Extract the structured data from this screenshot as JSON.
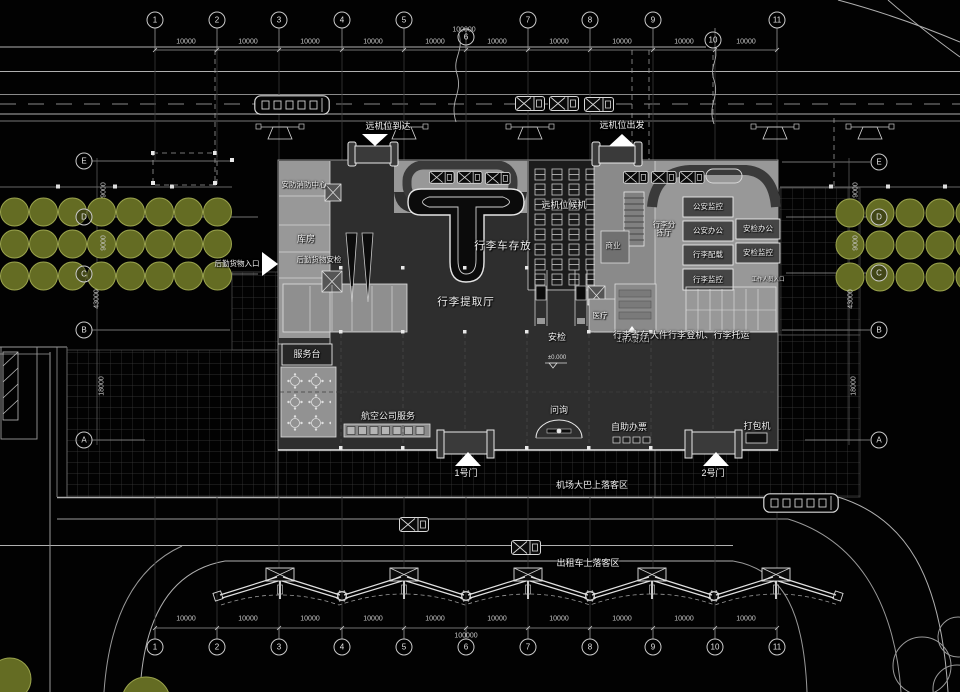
{
  "grid": {
    "top": [
      "1",
      "2",
      "3",
      "4",
      "5",
      "6",
      "7",
      "8",
      "9",
      "10",
      "11"
    ],
    "bottom": [
      "1",
      "2",
      "3",
      "4",
      "5",
      "6",
      "7",
      "8",
      "9",
      "10",
      "11"
    ],
    "left": [
      "E",
      "D",
      "C",
      "B",
      "A"
    ],
    "right": [
      "E",
      "D",
      "C",
      "B",
      "A"
    ]
  },
  "dims": {
    "bay": "10000",
    "total": "100000",
    "v9000": "9000",
    "v43000": "43000",
    "v18000": "18000",
    "level": "±0.000"
  },
  "site": {
    "remote_arrival": "远机位到达",
    "remote_departure": "远机位出发",
    "cargo_entrance": "后勤货物入口",
    "bus_zone": "机场大巴上落客区",
    "taxi_zone": "出租车上落客区",
    "gate1": "1号门",
    "gate2": "2号门",
    "staff_entrance": "工作人员入口"
  },
  "rooms": {
    "security_fire_center": "安防消防中心",
    "storage": "库房",
    "logistics_cargo_check": "后勤货物安检",
    "remote_stand_waiting": "远机位候机",
    "baggage_cart_storage": "行李车存放",
    "baggage_claim_hall": "行李提取厅",
    "baggage_sorting_hall": "行李分拣厅",
    "commercial": "商业",
    "police_monitoring": "公安监控",
    "police_office": "公安办公",
    "baggage_stowage": "行李配载",
    "baggage_monitoring": "行李监控",
    "security_office": "安检办公",
    "security_monitoring": "安检监控",
    "medical": "医疗",
    "security_check": "安检",
    "baggage_deposit": "行李寄存",
    "oversize_baggage": "大件行李",
    "boarding_baggage_checkin": "登机、行李托运",
    "service_desk": "服务台",
    "airline_service": "航空公司服务",
    "information": "问询",
    "self_service_ticketing": "自助办票",
    "packing_machine": "打包机"
  },
  "colors": {
    "background": "#020202",
    "building_light": "#989898",
    "building_dark": "#2e2e2e",
    "tree_fill": "#646c23",
    "tree_stroke": "#9aa34c",
    "line": "#b0b0b0"
  }
}
